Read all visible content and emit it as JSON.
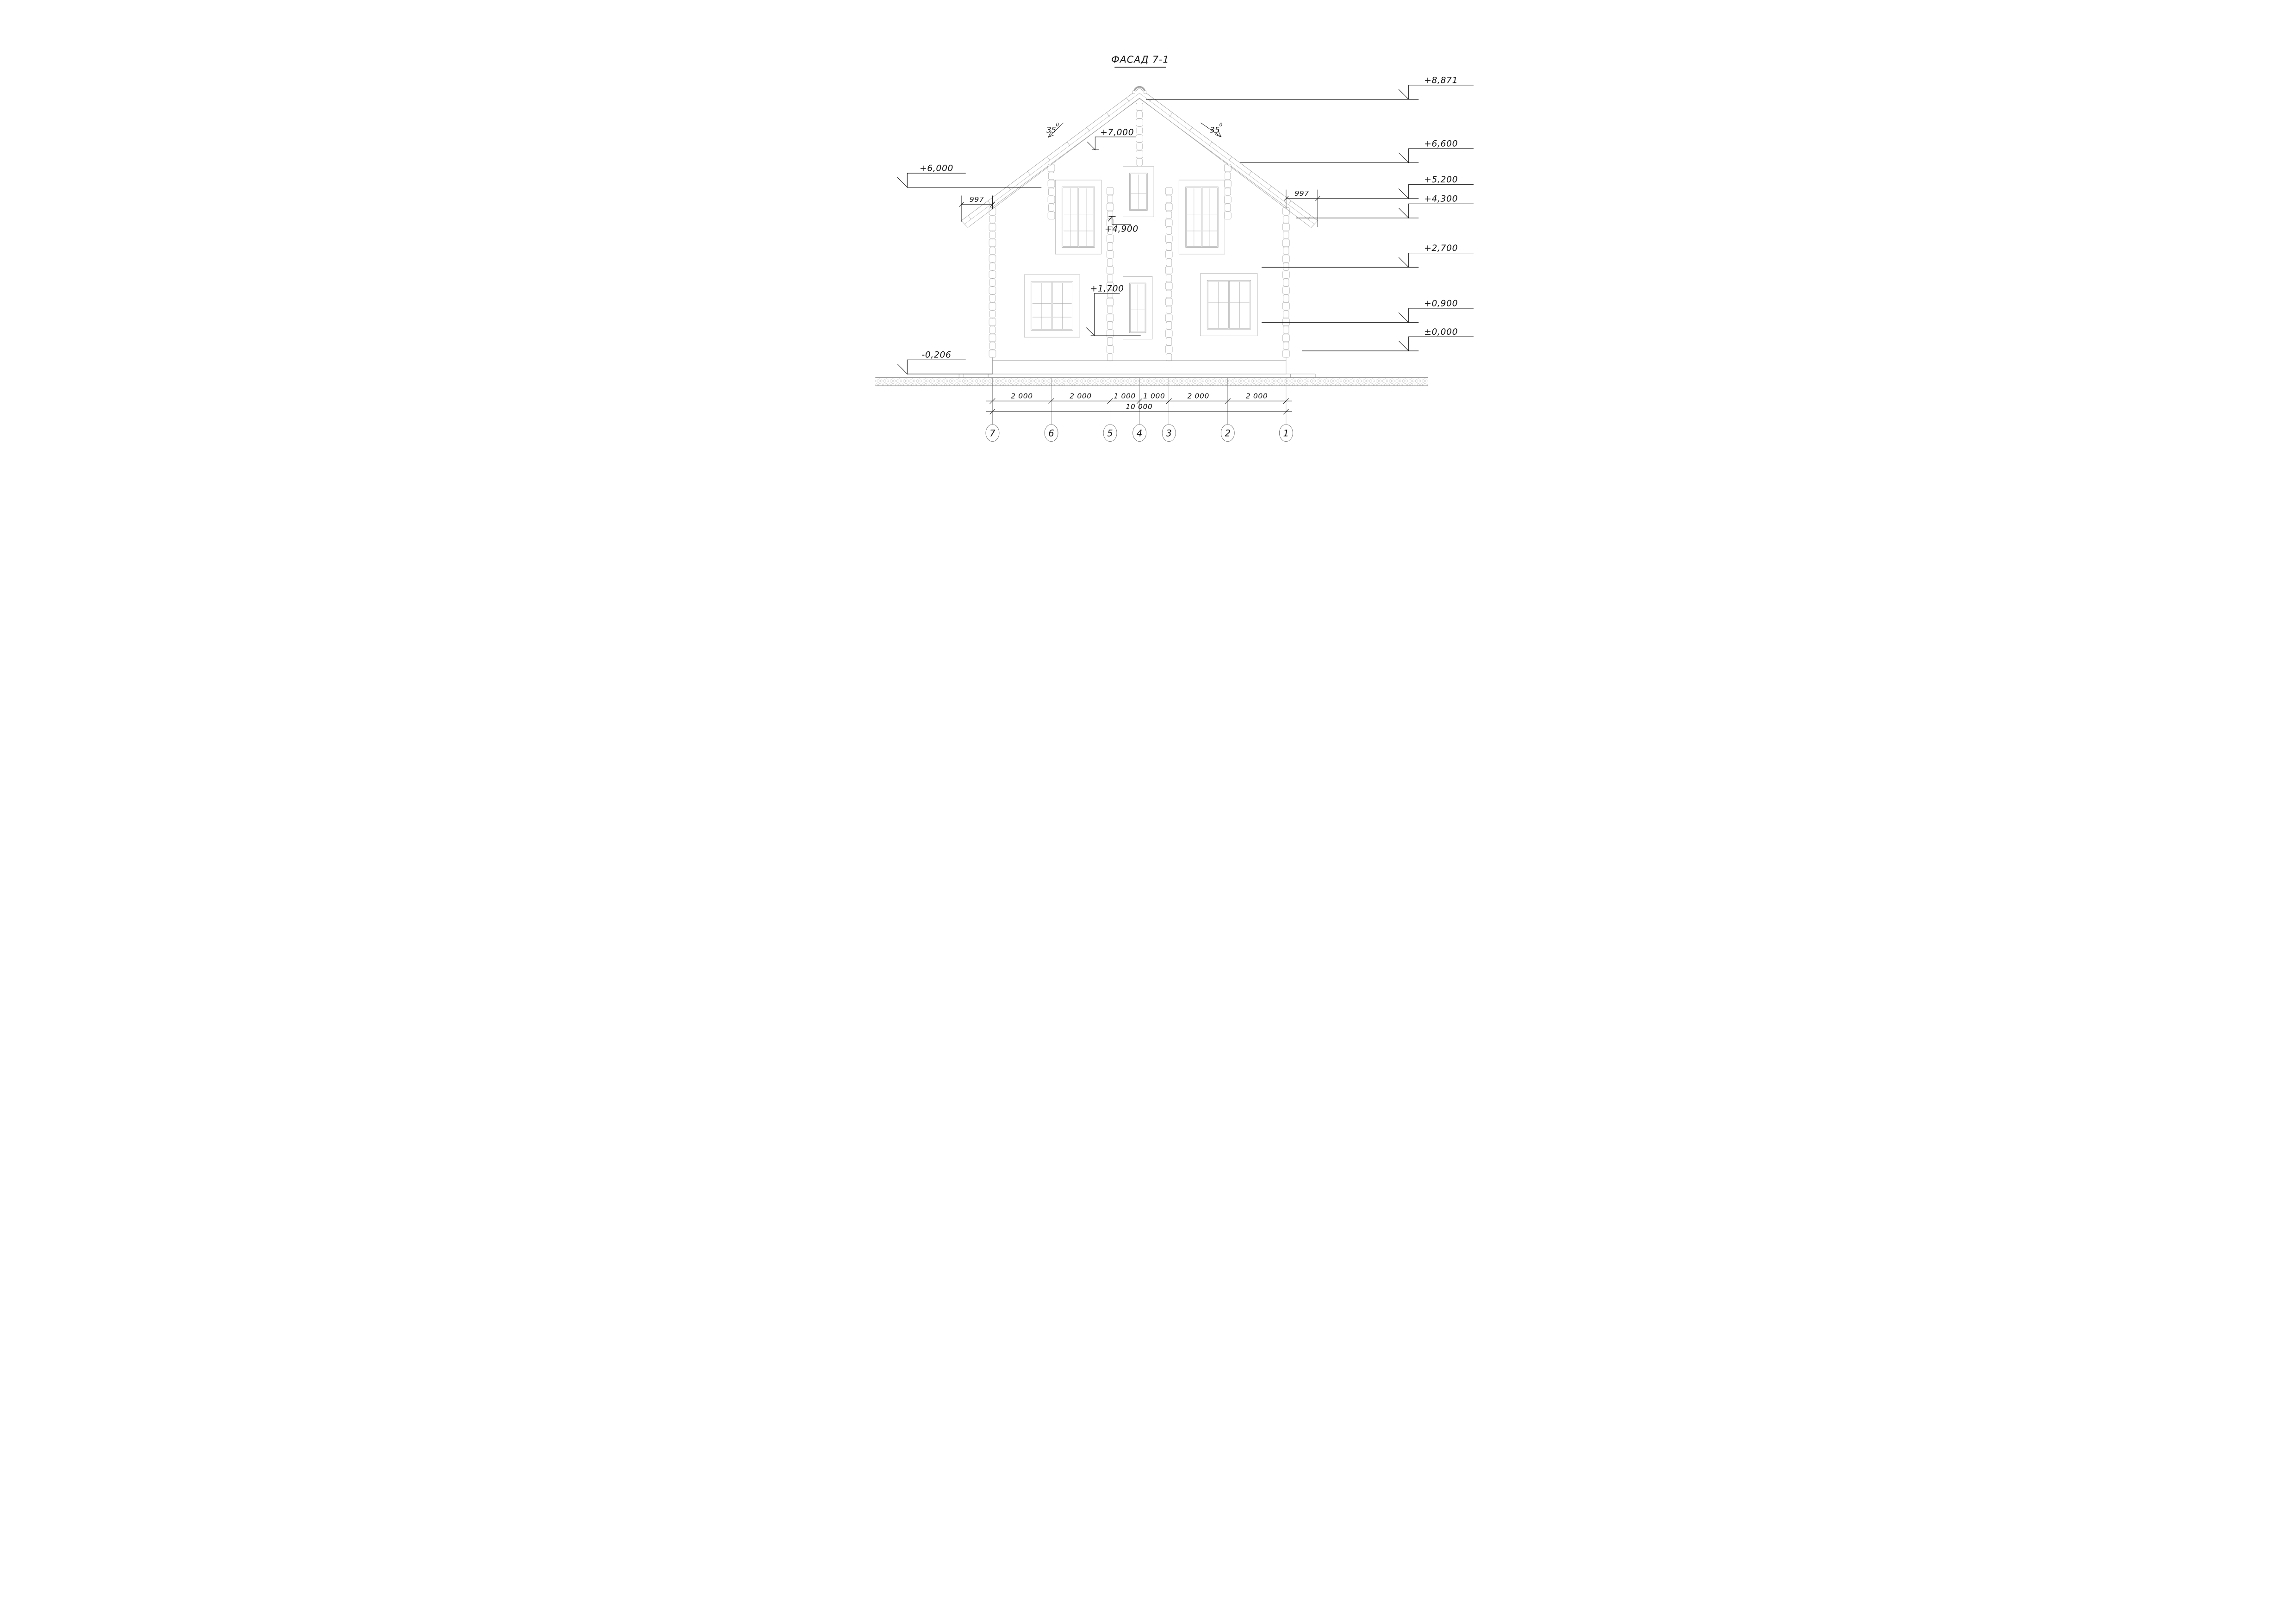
{
  "title": {
    "text": "ФАСАД 7-1"
  },
  "levels": {
    "right": [
      {
        "label": "+8,871"
      },
      {
        "label": "+6,600"
      },
      {
        "label": "+5,200"
      },
      {
        "label": "+4,300"
      },
      {
        "label": "+2,700"
      },
      {
        "label": "+0,900"
      },
      {
        "label": "±0,000"
      }
    ],
    "left": [
      {
        "label": "+6,000"
      },
      {
        "label": "-0,206"
      }
    ],
    "mid": [
      {
        "label": "+7,000"
      },
      {
        "label": "+4,900"
      },
      {
        "label": "+1,700"
      }
    ]
  },
  "roof": {
    "angle_left": {
      "value": "35",
      "sup": "0"
    },
    "angle_right": {
      "value": "35",
      "sup": "0"
    },
    "overhang_left": "997",
    "overhang_right": "997"
  },
  "dimensions": {
    "segments": [
      "2 000",
      "2 000",
      "1 000",
      "1 000",
      "2 000",
      "2 000"
    ],
    "total": "10 000"
  },
  "axes": {
    "labels": [
      "7",
      "6",
      "5",
      "4",
      "3",
      "2",
      "1"
    ]
  },
  "colors": {
    "annotation": "#141414",
    "drawing": "#9c9c9c",
    "ground": "#8a8a8a",
    "background": "#ffffff"
  }
}
